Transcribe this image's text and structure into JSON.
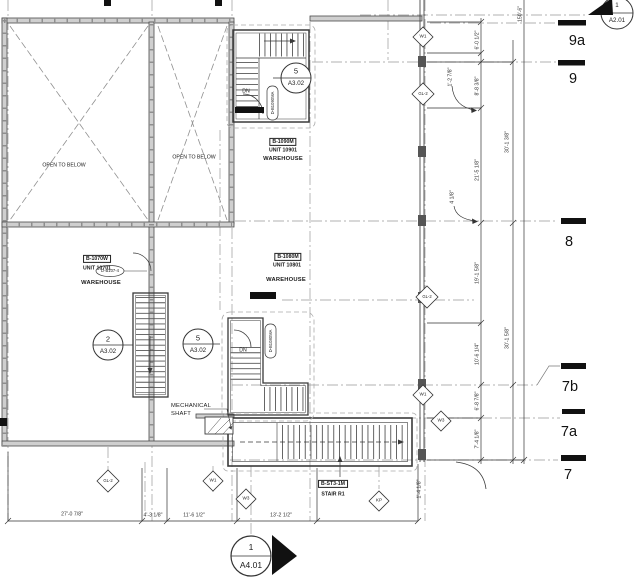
{
  "rooms": [
    {
      "tag": "B-1070W",
      "unit": "UNIT 10701",
      "name": "WAREHOUSE"
    },
    {
      "tag": "B-1090M",
      "unit": "UNIT 10901",
      "name": "WAREHOUSE"
    },
    {
      "tag": "B-1080M",
      "unit": "UNIT 10801",
      "name": "WAREHOUSE"
    }
  ],
  "open_to_below": "OPEN TO BELOW",
  "dn": "DN",
  "mechanical": {
    "line1": "MECHANICAL",
    "line2": "SHAFT"
  },
  "stair": {
    "tag": "B-ST3-1M",
    "name": "STAIR R1"
  },
  "door_tags": {
    "d107": "D-B107-4",
    "d1090": "D-B1090MA",
    "d1080": "D-B1080MA"
  },
  "callouts": {
    "stair2": {
      "num": "2",
      "sheet": "A3.02"
    },
    "stair5": {
      "num": "5",
      "sheet": "A3.02"
    },
    "section_top": {
      "num": "1",
      "sheet": "A2.01"
    },
    "section_bottom": {
      "num": "1",
      "sheet": "A4.01"
    }
  },
  "grid_labels": [
    "9a",
    "9",
    "8",
    "7b",
    "7a",
    "7"
  ],
  "keynotes": {
    "w1": "W1",
    "w3": "W3",
    "gl2": "GL-2",
    "kp": "KP"
  },
  "dims": {
    "bottom": [
      "27'-0 7/8\"",
      "4'-3 1/8\"",
      "11'-6 1/2\"",
      "13'-2 1/2\""
    ],
    "right_inner": [
      "6'-0 1/2\"",
      "8'-8 3/8\"",
      "21'-5 1/8\"",
      "19'-1 5/8\"",
      "10'-6 1/4\"",
      "6'-8 7/8\"",
      "7'-4 1/8\""
    ],
    "right_outer": [
      "30'-1 3/8\"",
      "30'-1 5/8\"",
      "150'-6\""
    ],
    "leaders": [
      "1'-2 7/8\"",
      "4 1/8\"",
      "1'-4 1/8\""
    ]
  },
  "colors": {
    "line": "#3a3a3a",
    "grid": "#999999",
    "wall_fill": "#cfcfcf",
    "black": "#111111"
  }
}
